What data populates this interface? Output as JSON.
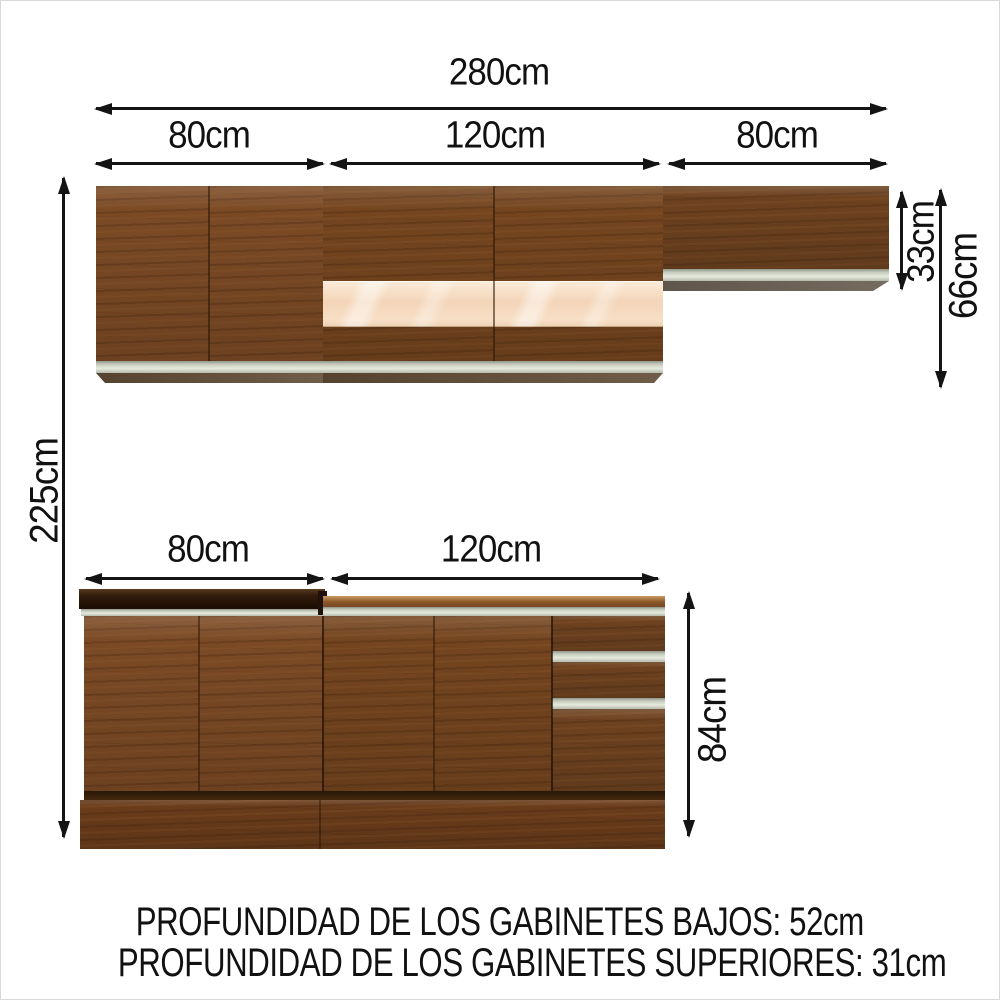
{
  "dimensions": {
    "total_width": "280cm",
    "total_height": "225cm",
    "upper": {
      "left_width": "80cm",
      "middle_width": "120cm",
      "right_width": "80cm",
      "right_cabinet_height": "33cm",
      "cabinet_height": "66cm"
    },
    "lower": {
      "left_width": "80cm",
      "middle_width": "120cm",
      "cabinet_height": "84cm"
    }
  },
  "notes": {
    "line1": "PROFUNDIDAD DE LOS GABINETES BAJOS: 52cm",
    "line2": "PROFUNDIDAD DE LOS GABINETES SUPERIORES: 31cm"
  },
  "colors": {
    "wood": "#7b4a25",
    "wood_dark": "#6d4220",
    "plinth": "#693c1b",
    "glass_panel": "#f5dcc2",
    "silver_trim": "#ccd2c4",
    "counter_dark": "#2a1708",
    "underside_gray": "#6a6157",
    "arrow": "#141414",
    "background": "#ffffff"
  }
}
